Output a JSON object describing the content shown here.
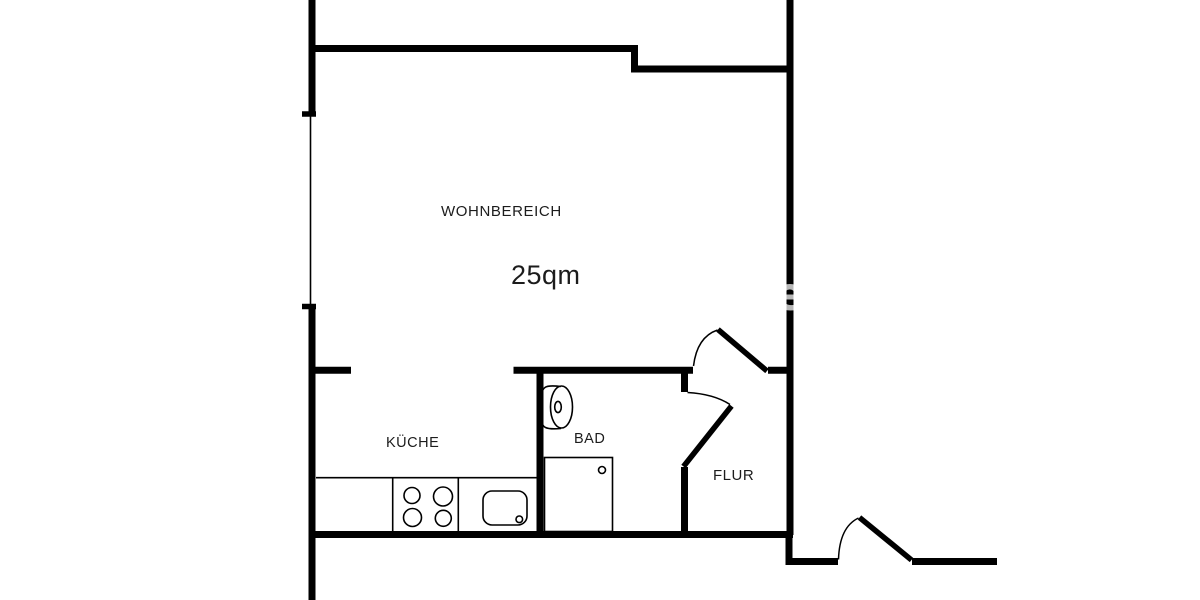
{
  "document": {
    "type": "floor-plan",
    "background": "#ffffff"
  },
  "colors": {
    "wall": "#000000",
    "thin_line": "#000000",
    "text": "#1c1c1c"
  },
  "rooms": {
    "wohnbereich": {
      "label": "WOHNBEREICH",
      "area": "25qm"
    },
    "kueche": {
      "label": "KÜCHE"
    },
    "bad": {
      "label": "BAD"
    },
    "flur": {
      "label": "FLUR"
    }
  },
  "fixtures": {
    "stove": "stove-burners-icon",
    "sink": "kitchen-sink-icon",
    "toilet": "toilet-icon",
    "shower": "shower-tray-icon",
    "window": "window-line",
    "doors": [
      "entrance-door",
      "bath-door",
      "building-door"
    ]
  },
  "watermark": {
    "text": "e"
  }
}
